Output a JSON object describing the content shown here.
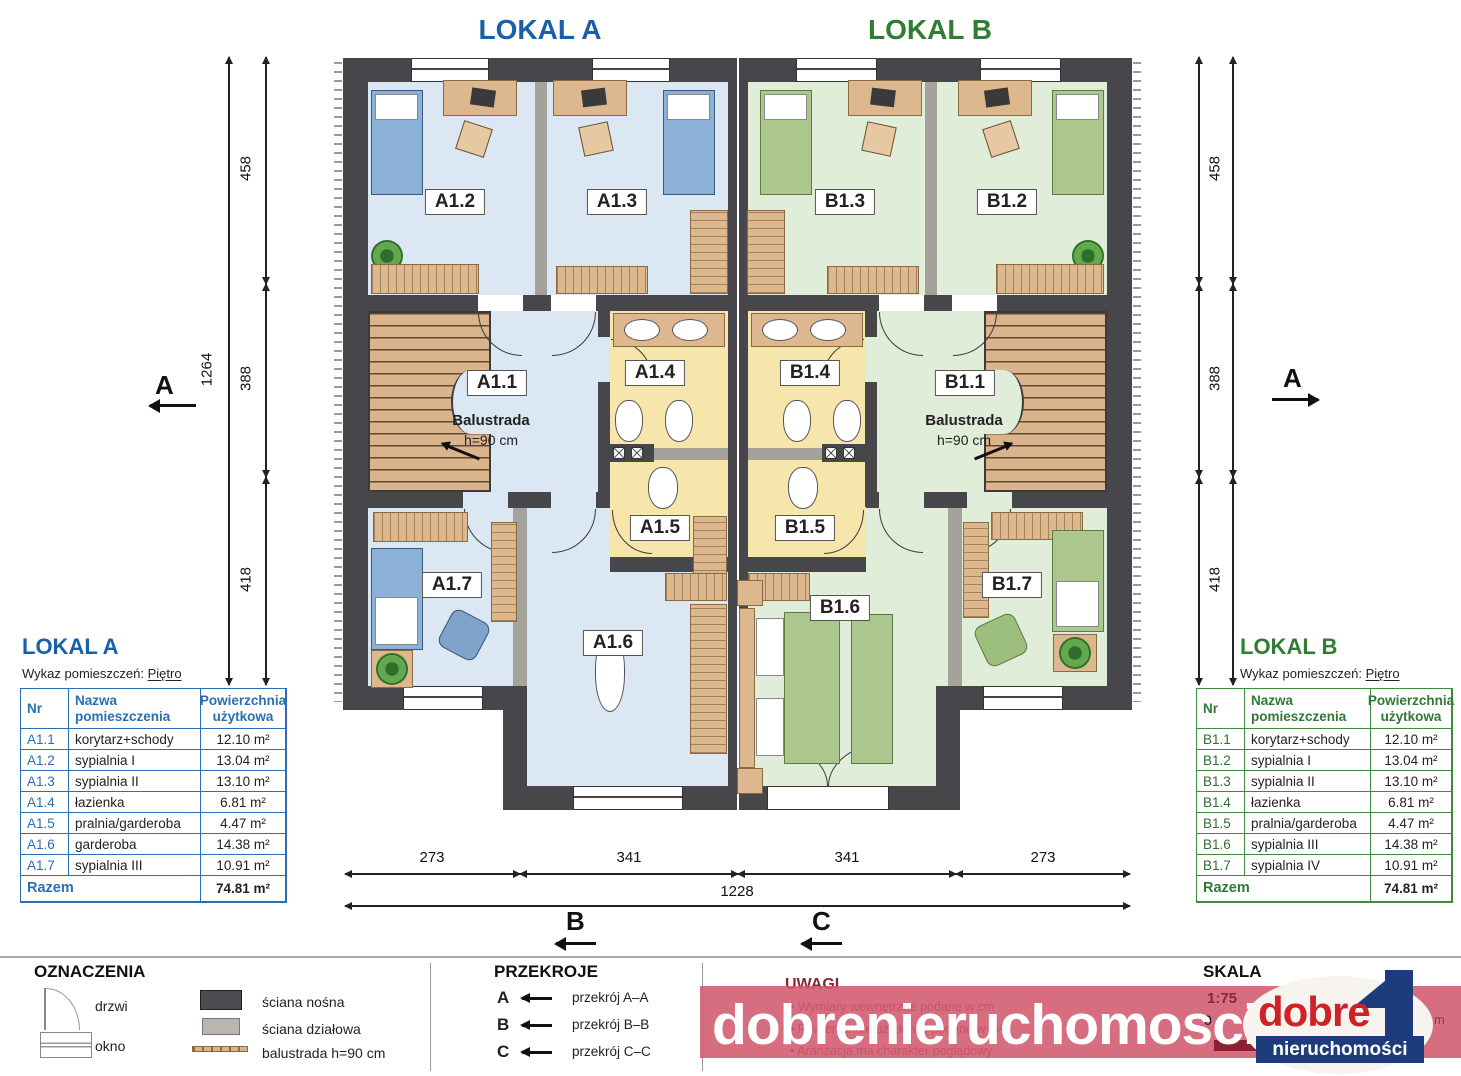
{
  "header": {
    "lokal_a": "LOKAL A",
    "lokal_b": "LOKAL B"
  },
  "plan": {
    "labels": {
      "a11": "A1.1",
      "a12": "A1.2",
      "a13": "A1.3",
      "a14": "A1.4",
      "a15": "A1.5",
      "a16": "A1.6",
      "a17": "A1.7",
      "b11": "B1.1",
      "b12": "B1.2",
      "b13": "B1.3",
      "b14": "B1.4",
      "b15": "B1.5",
      "b16": "B1.6",
      "b17": "B1.7"
    },
    "balustrada": {
      "title": "Balustrada",
      "height": "h=90 cm"
    }
  },
  "dimensions": {
    "left": {
      "segments": [
        "458",
        "388",
        "418"
      ],
      "total": "1264"
    },
    "right": {
      "segments": [
        "458",
        "388",
        "418"
      ]
    },
    "bottom": {
      "segments": [
        "273",
        "341",
        "341",
        "273"
      ],
      "total": "1228"
    }
  },
  "markers": {
    "a": "A",
    "b": "B",
    "c": "C"
  },
  "tables": {
    "a": {
      "title": "LOKAL A",
      "subtitle_prefix": "Wykaz pomieszczeń: ",
      "subtitle_floor": "Piętro",
      "headers": {
        "nr": "Nr",
        "name": "Nazwa pomieszczenia",
        "area": "Powierzchnia użytkowa"
      },
      "rows": [
        {
          "nr": "A1.1",
          "name": "korytarz+schody",
          "area": "12.10 m²"
        },
        {
          "nr": "A1.2",
          "name": "sypialnia I",
          "area": "13.04 m²"
        },
        {
          "nr": "A1.3",
          "name": "sypialnia II",
          "area": "13.10 m²"
        },
        {
          "nr": "A1.4",
          "name": "łazienka",
          "area": "6.81 m²"
        },
        {
          "nr": "A1.5",
          "name": "pralnia/garderoba",
          "area": "4.47 m²"
        },
        {
          "nr": "A1.6",
          "name": "garderoba",
          "area": "14.38 m²"
        },
        {
          "nr": "A1.7",
          "name": "sypialnia III",
          "area": "10.91 m²"
        }
      ],
      "total_label": "Razem",
      "total_value": "74.81 m²"
    },
    "b": {
      "title": "LOKAL B",
      "subtitle_prefix": "Wykaz pomieszczeń: ",
      "subtitle_floor": "Piętro",
      "headers": {
        "nr": "Nr",
        "name": "Nazwa pomieszczenia",
        "area": "Powierzchnia użytkowa"
      },
      "rows": [
        {
          "nr": "B1.1",
          "name": "korytarz+schody",
          "area": "12.10 m²"
        },
        {
          "nr": "B1.2",
          "name": "sypialnia I",
          "area": "13.04 m²"
        },
        {
          "nr": "B1.3",
          "name": "sypialnia II",
          "area": "13.10 m²"
        },
        {
          "nr": "B1.4",
          "name": "łazienka",
          "area": "6.81 m²"
        },
        {
          "nr": "B1.5",
          "name": "pralnia/garderoba",
          "area": "4.47 m²"
        },
        {
          "nr": "B1.6",
          "name": "sypialnia III",
          "area": "14.38 m²"
        },
        {
          "nr": "B1.7",
          "name": "sypialnia IV",
          "area": "10.91 m²"
        }
      ],
      "total_label": "Razem",
      "total_value": "74.81 m²"
    }
  },
  "legend": {
    "heading": "OZNACZENIA",
    "items": [
      "drzwi",
      "okno",
      "ściana nośna",
      "ściana działowa",
      "balustrada h=90 cm"
    ]
  },
  "sections": {
    "heading": "PRZEKROJE",
    "rows": [
      {
        "letter": "A",
        "label": "przekrój A–A"
      },
      {
        "letter": "B",
        "label": "przekrój B–B"
      },
      {
        "letter": "C",
        "label": "przekrój C–C"
      }
    ]
  },
  "notes": {
    "heading": "UWAGI",
    "bullets": [
      "Wymiary wewnętrzne podane w cm",
      "Powierzchnie użytkowe podane w m²",
      "Aranżacja ma charakter poglądowy"
    ]
  },
  "scale": {
    "heading": "SKALA",
    "ratio": "1:75",
    "zero": "0",
    "unit": "m"
  },
  "watermark": {
    "text": "dobrenieruchomosci.eu",
    "brand_top": "dobre",
    "brand_bottom": "nieruchomości"
  },
  "colors": {
    "accent_a": "#1a5fa8",
    "accent_b": "#2e7d32",
    "wall": "#47474b",
    "floor_a": "#dbe7f3",
    "floor_b": "#e0edd9",
    "wet_room": "#f6e6ab",
    "watermark_band": "#d05a6e",
    "logo_red": "#cf2127",
    "logo_blue": "#1e3c7c"
  }
}
